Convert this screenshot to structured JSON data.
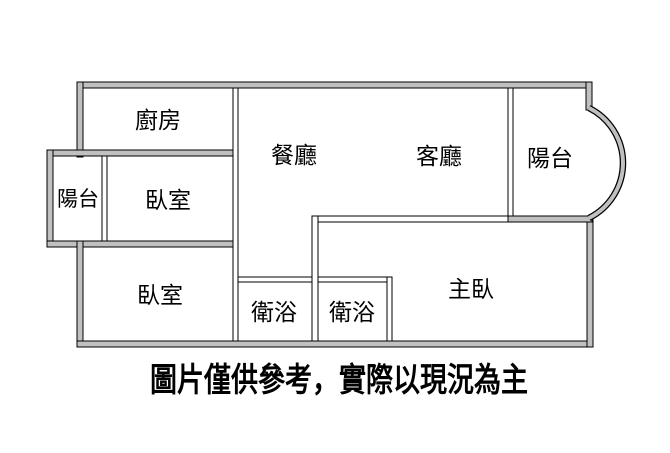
{
  "plan": {
    "labels": {
      "kitchen": "廚房",
      "dining": "餐廳",
      "living": "客廳",
      "balcony_left": "陽台",
      "balcony_right": "陽台",
      "bedroom_upper": "臥室",
      "bedroom_lower": "臥室",
      "bathroom_left": "衛浴",
      "bathroom_right": "衛浴",
      "master_bedroom": "主臥"
    },
    "caption": "圖片僅供參考，實際以現況為主",
    "colors": {
      "wall_fill": "#c0c0c0",
      "wall_outline": "#000000",
      "label_text": "#000000",
      "background": "#ffffff"
    }
  }
}
